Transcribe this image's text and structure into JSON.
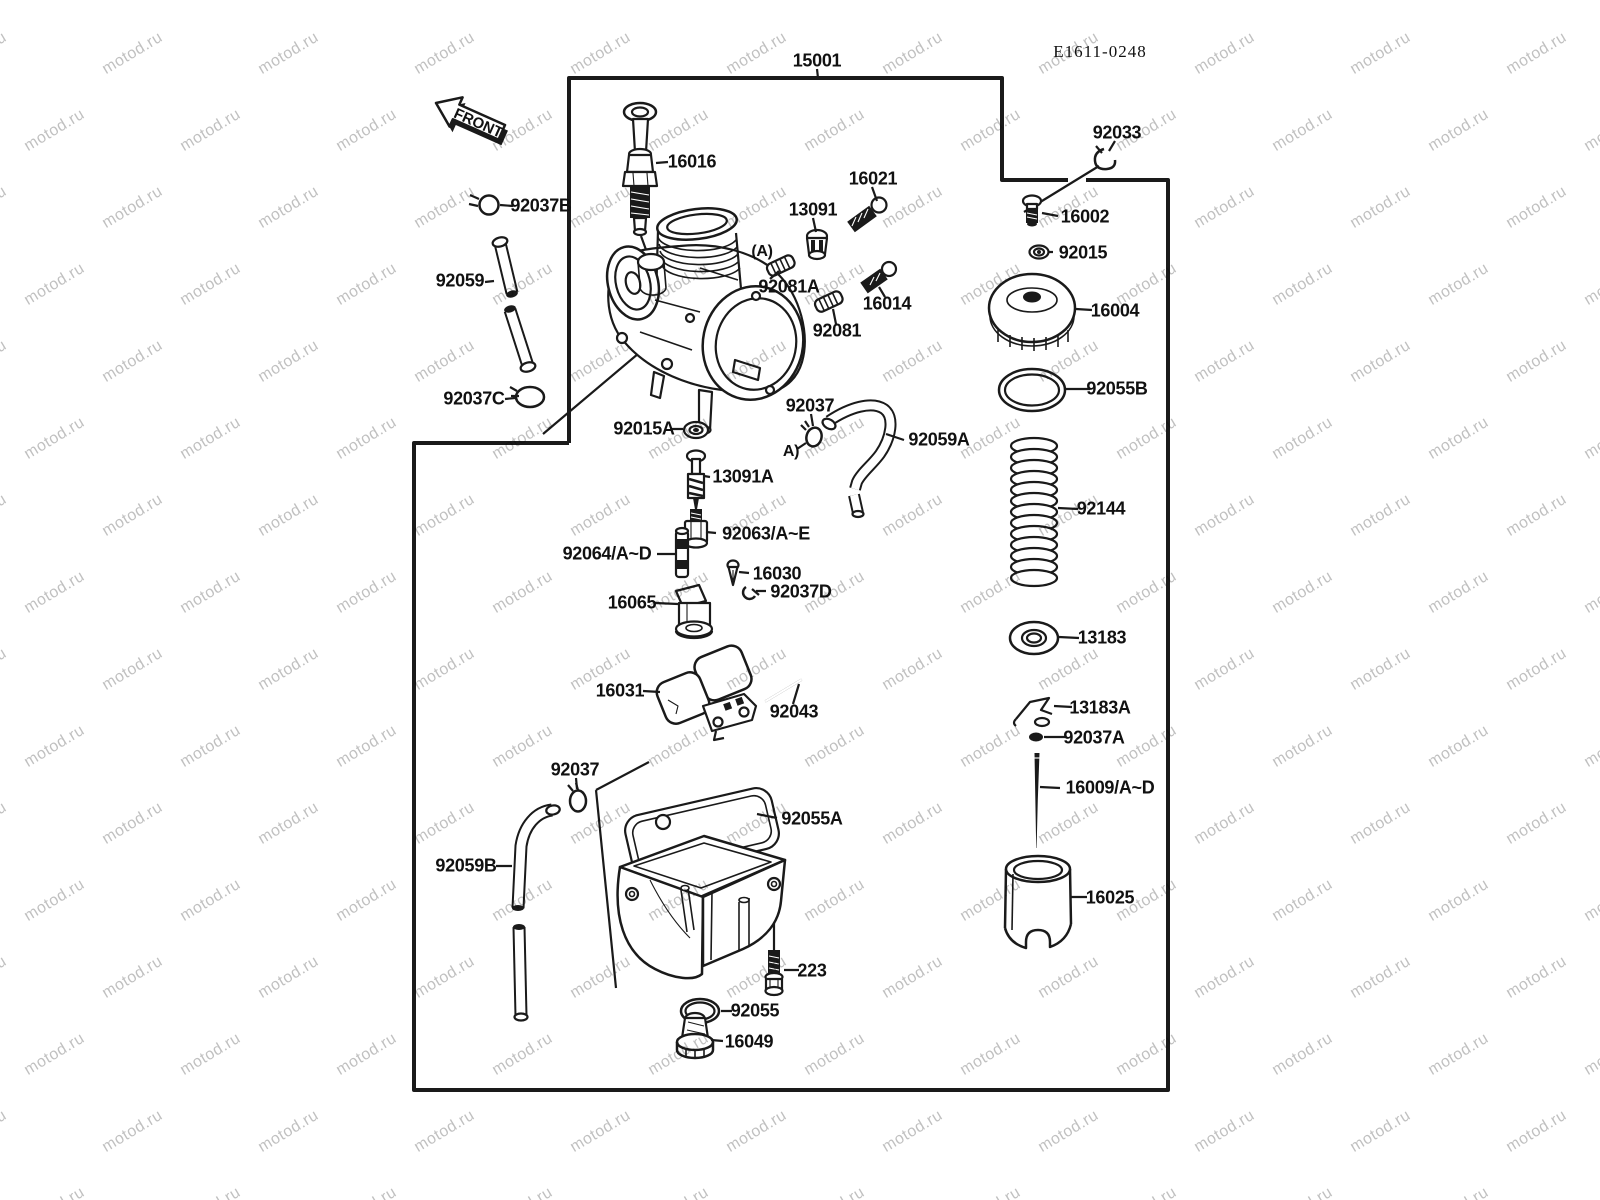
{
  "watermark": {
    "text": "motod.ru",
    "color": "#979797"
  },
  "colors": {
    "line": "#1a1a1a",
    "background": "#ffffff"
  },
  "labels": {
    "p15001": "15001",
    "code": "E1611-0248",
    "front": "FRONT",
    "p16016": "16016",
    "p92037B": "92037B",
    "p92059": "92059",
    "p92037C": "92037C",
    "p13091": "13091",
    "p16021": "16021",
    "p92081A": "92081A",
    "p16014": "16014",
    "p92081": "92081",
    "p92033": "92033",
    "p16002": "16002",
    "p92015": "92015",
    "p16004": "16004",
    "p92055B": "92055B",
    "p92144": "92144",
    "p13183": "13183",
    "p13183A": "13183A",
    "p92037A": "92037A",
    "p16009": "16009/A~D",
    "p16025": "16025",
    "p92015A": "92015A",
    "p92037_mid": "92037",
    "pA_mid": "A)",
    "pA_body": "(A)",
    "p92059A": "92059A",
    "p13091A": "13091A",
    "p92063": "92063/A~E",
    "p92064": "92064/A~D",
    "p16030": "16030",
    "p92037D": "92037D",
    "p16065": "16065",
    "p16031": "16031",
    "p92043": "92043",
    "p92037_low": "92037",
    "p92055A": "92055A",
    "p92059B": "92059B",
    "p223": "223",
    "p92055": "92055",
    "p16049": "16049"
  }
}
